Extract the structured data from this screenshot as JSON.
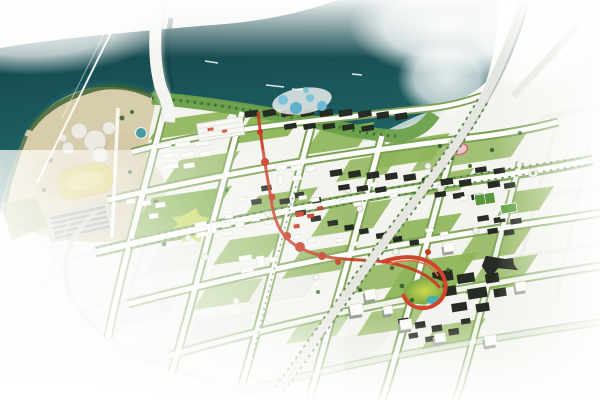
{
  "meta": {
    "kind": "urban-master-plan-rendering",
    "view": "aerial-oblique",
    "description": "Bird's-eye rendering of a riverside urban master plan: dark teal river and bay at top, waterfront dome park peninsula at left, dense mid-rise city grid in the center, red landmark spine and ribbon walkway, highway crossing from the top-right, planned blocks fading to white at the edges"
  },
  "features": {
    "river": "river-and-bay",
    "haze": "fog-overexposure-top-right",
    "main_bridge": "vertical-river-bridge",
    "cable_bridge": "thin-cable-stay-crossing",
    "highway": "diagonal-arterial-highway",
    "peninsula": "sandy-waterfront-park-peninsula",
    "domes": "white-dome-pavilions",
    "yellow_field": "yellow-event-lawn",
    "striped_sheds": "row-shed-complex",
    "central_park": "central-green-park",
    "red_spine": "red-pedestrian-spine",
    "red_ribbon": "red-ribbon-loop-walkway",
    "stadium": "pink-oval-stadium",
    "sports_fields": "green-sports-courts",
    "waterpark": "blue-pool-waterpark",
    "ghost_blocks": "faded-future-phase-blocks"
  },
  "colors": {
    "land": "#f3f4ee",
    "water_dark": "#113e43",
    "water_light": "#236d70",
    "shore_sand": "#e7ddc1",
    "sand": "#d8cdab",
    "lawn": "#8db457",
    "park": "#7fae49",
    "splat": "#c3d74f",
    "tree": "#355f2e",
    "road_white": "#fcfcfa",
    "road_edge_green": "#7ba253",
    "highway": "#e6e6e0",
    "bridge": "#f4f4f0",
    "building_white": "#fbfbf8",
    "building_dark": "#262b23",
    "shadow_gray": "#9aa098",
    "red_spine": "#c63a24",
    "ribbon_red": "#d2442c",
    "pond_teal": "#4b9aa2",
    "pool_blue": "#7fc3d8",
    "field_yellow": "#d7ca63",
    "stadium_pink": "#eec6cd",
    "stadium_ring": "#c96d78",
    "haze_white": "#ffffff"
  }
}
